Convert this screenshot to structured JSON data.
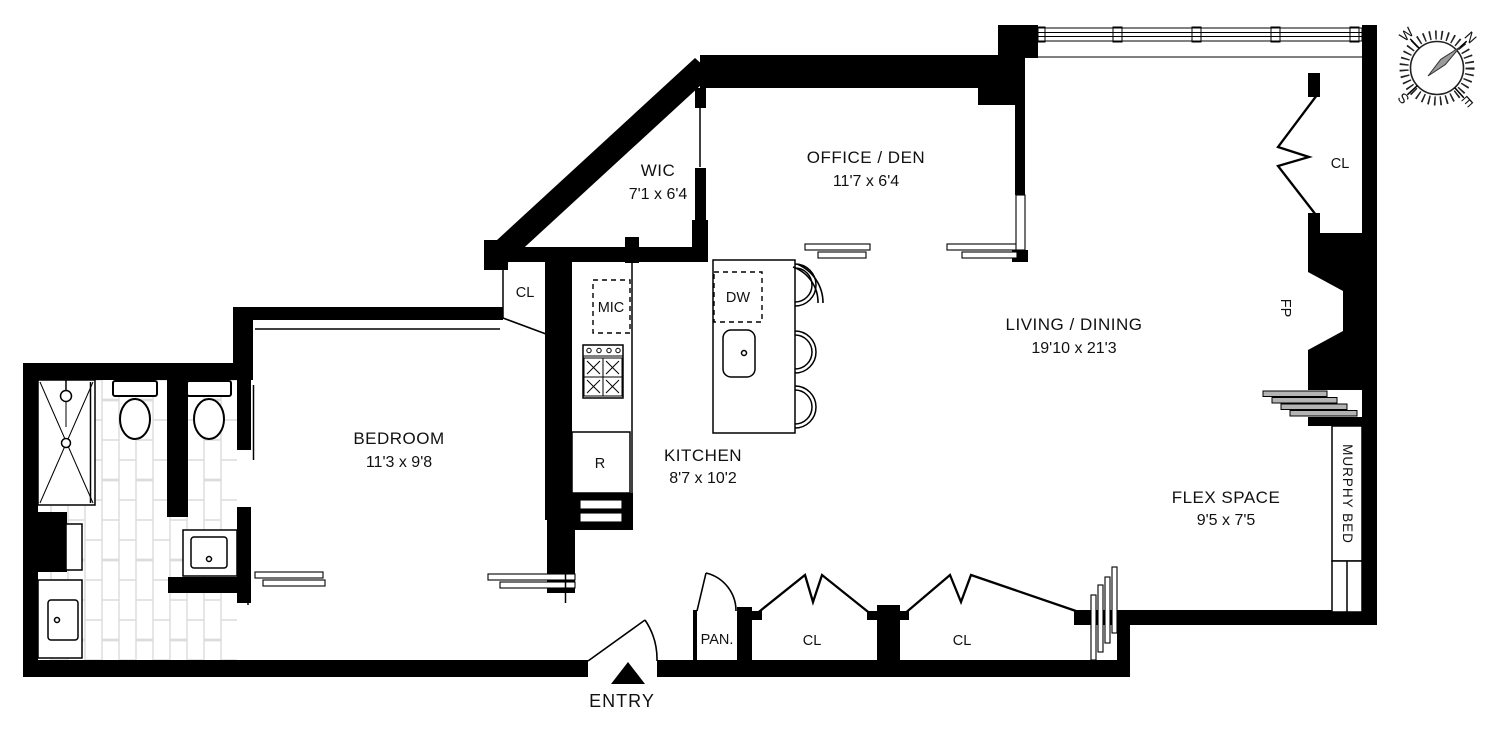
{
  "colors": {
    "wall": "#000000",
    "hvac": "#b3b3b3",
    "needle": "#9b9b9b",
    "tile_line": "#dcdcdc"
  },
  "rooms": {
    "wic": {
      "label": "WIC",
      "dims": "7'1 x 6'4"
    },
    "office_den": {
      "label": "OFFICE / DEN",
      "dims": "11'7 x 6'4"
    },
    "living_dining": {
      "label": "LIVING / DINING",
      "dims": "19'10 x 21'3"
    },
    "bedroom": {
      "label": "BEDROOM",
      "dims": "11'3 x 9'8"
    },
    "kitchen": {
      "label": "KITCHEN",
      "dims": "8'7 x 10'2"
    },
    "flex_space": {
      "label": "FLEX SPACE",
      "dims": "9'5 x 7'5"
    }
  },
  "features": {
    "entry": "ENTRY",
    "pantry": "PAN.",
    "closet_bedroom": "CL",
    "closet_upper_right": "CL",
    "closet_hall_left": "CL",
    "closet_hall_right": "CL",
    "murphy_bed": "MURPHY BED",
    "fireplace": "FP"
  },
  "appliances": {
    "microwave": "MIC",
    "dishwasher": "DW",
    "refrigerator": "R"
  },
  "compass": {
    "north": "N",
    "east": "E",
    "south": "S",
    "west": "W"
  }
}
